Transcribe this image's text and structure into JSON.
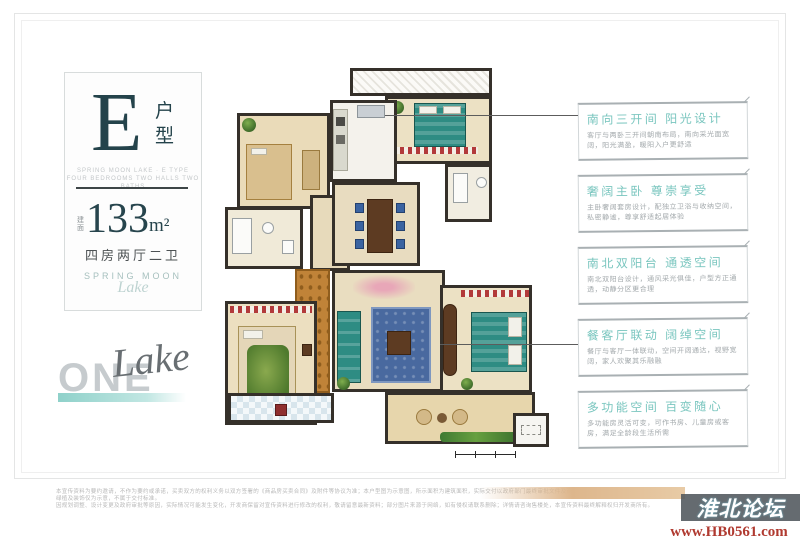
{
  "panel": {
    "unit_letter": "E",
    "unit_suffix": "户型",
    "subtitle_line1": "SPRING MOON LAKE · E TYPE",
    "subtitle_line2": "FOUR BEDROOMS TWO HALLS TWO BATHS",
    "area_prefix": "建面",
    "area_number": "133",
    "area_unit": "m²",
    "layout_label": "四房两厅二卫",
    "brand_en": "SPRING MOON",
    "brand_script": "Lake"
  },
  "logo": {
    "word": "ONE",
    "script": "Lake"
  },
  "callouts": [
    {
      "title": "南向三开间 阳光设计",
      "body": "客厅与两卧三开间朝南布局，南向采光面宽阔，阳光满盈，暖阳入户更舒适"
    },
    {
      "title": "奢阔主卧 尊崇享受",
      "body": "主卧奢阔套房设计，配独立卫浴与收纳空间，私密静谧，尊享舒适起居体验"
    },
    {
      "title": "南北双阳台 通透空间",
      "body": "南北双阳台设计，通风采光俱佳，户型方正通透，动静分区更合理"
    },
    {
      "title": "餐客厅联动 阔绰空间",
      "body": "餐厅与客厅一体联动，空间开阔通达，视野宽阔，家人欢聚其乐融融"
    },
    {
      "title": "多功能空间 百变随心",
      "body": "多功能房灵活可变，可作书房、儿童房或客房，满足全龄段生活所需"
    }
  ],
  "disclaimer": {
    "line1": "本宣传资料为要约邀请，不作为要约或承诺，买卖双方的权利义务以双方签署的《商品房买卖合同》及附件等协议为准；本户型图为示意图，所示面积为建筑面积，实际交付以政府部门最终审批文件及商品房买卖合同约定为准；图中家具、绿植及装饰仅为示意，不属于交付标准。",
    "line2": "因规划调整、设计变更及政府审批等原因，实际情况可能发生变化，开发商保留对宣传资料进行修改的权利，敬请留意最新资料；部分图片来源于网络，如有侵权请联系删除；详情请咨询售楼处，本宣传资料最终解释权归开发商所有。"
  },
  "watermark": {
    "site": "淮北论坛",
    "url": "www.HB0561.com"
  },
  "colors": {
    "accent_teal": "#7ac6bf",
    "ink_navy": "#24434b",
    "wall": "#35302a",
    "underline_teal": "#8fd1ca",
    "watermark_bg": "#50565c",
    "url_red": "#b03a30",
    "gradient_tan": "#ddb68c"
  }
}
